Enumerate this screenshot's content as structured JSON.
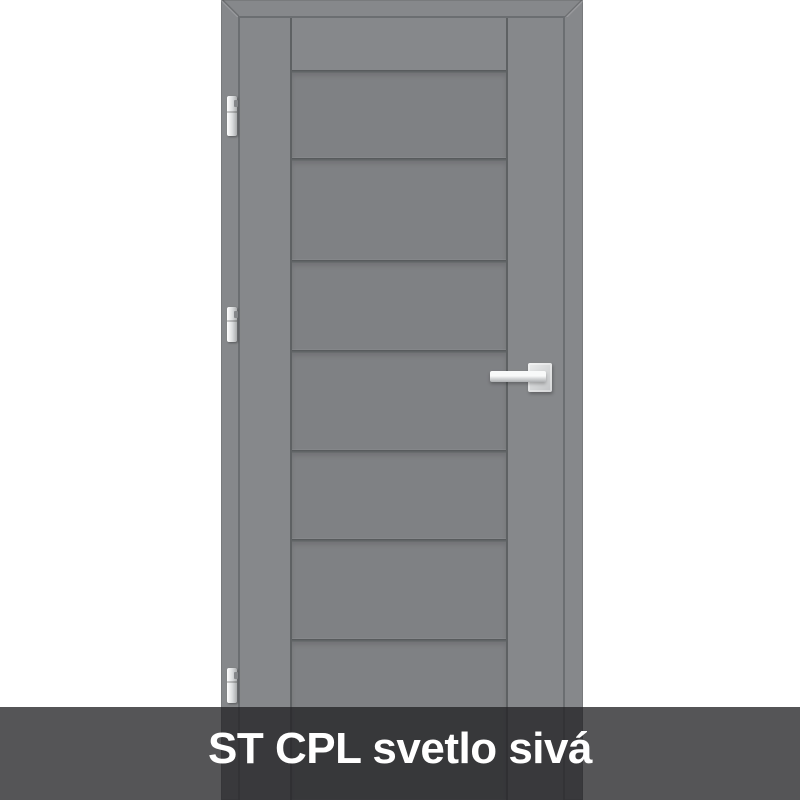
{
  "banner": {
    "label": "ST CPL svetlo sivá"
  },
  "door": {
    "hinge_count": 3,
    "panel_count": 7
  },
  "theme": {
    "page-bg": "#ffffff",
    "door-base": "#86888b",
    "door-panel": "#7f8184",
    "door-groove": "#5e6163",
    "door-rebate": "#6b6e71",
    "hardware": "#e9eaeb",
    "banner-bg": "rgba(34,34,36,0.77)",
    "banner-text": "#ffffff"
  }
}
